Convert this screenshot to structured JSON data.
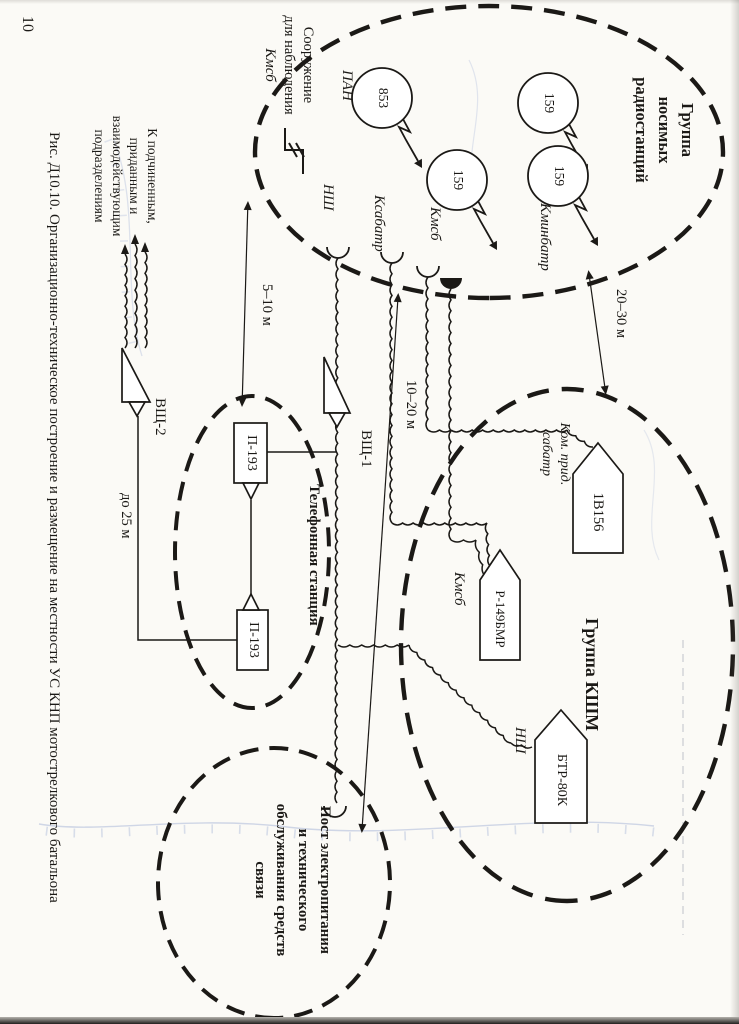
{
  "page": {
    "number": "10",
    "caption": "Рис. Д10.10.  Организационно-техническое построение и размещение на местности УС КНП мотострелкового батальона"
  },
  "radio_group": {
    "title_line1": "Группа",
    "title_line2": "носимых",
    "title_line3": "радиостанций",
    "station_853": "853",
    "station_159": "159",
    "label_pan": "ПАН",
    "label_kmsb": "Кмсб",
    "label_kminbatr": "Кминбатр"
  },
  "observation": {
    "line1": "Сооружение",
    "line2": "для наблюдения",
    "line3": "Кмсб"
  },
  "field_lines": {
    "label_nsh": "НШ",
    "label_ksabatr": "Ксабатр",
    "label_kmsb": "Кмсб"
  },
  "phone_station": {
    "title": "Телефонная станция",
    "p193": "П-193",
    "vsh1": "ВЩ-1",
    "vsh2": "ВЩ-2"
  },
  "kshm_group": {
    "title": "Группа КШМ",
    "vehicle_1v156": "1В156",
    "vehicle_r149": "Р-149БМР",
    "vehicle_btr": "БТР-80К",
    "label_kom_prid_line1": "Ком. прид.",
    "label_kom_prid_line2": "сабатр",
    "label_kmsb": "Кмсб",
    "label_nsh": "НШ"
  },
  "power_post": {
    "line1": "Пост электропитания",
    "line2": "и технического",
    "line3": "обслуживания средств",
    "line4": "связи"
  },
  "distances": {
    "d20_30": "20–30 м",
    "d5_10": "5–10 м",
    "d10_20": "10–20 м",
    "d25": "до 25 м"
  },
  "subordinates_note": {
    "line1": "К подчиненным,",
    "line2": "приданным и",
    "line3": "взаимодействующим",
    "line4": "подразделениям"
  },
  "colors": {
    "ink": "#1b1916",
    "topo_blue": "#a3b2d6",
    "paper": "#fbfaf6"
  }
}
